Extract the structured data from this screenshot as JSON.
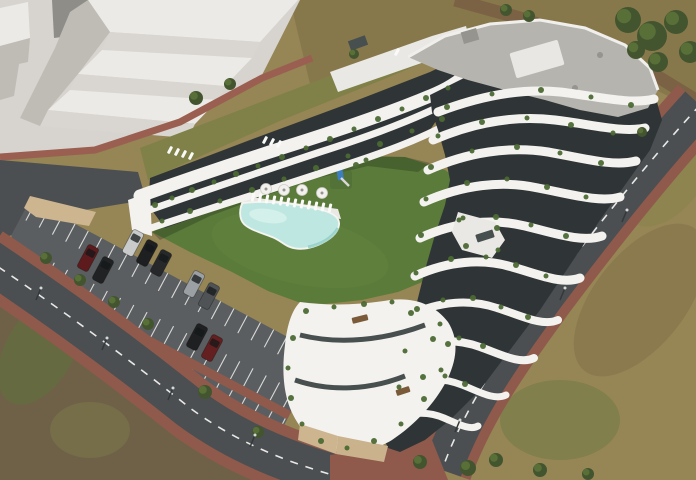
{
  "scene": {
    "type": "aerial 3D architectural render",
    "subject": "Modern terraced apartment complex with curved white balconies, gravel roof, communal lawn courtyard with free-form swimming pool, sun loungers, round tables, children's playground, perimeter roads and a surface parking lot with cars, surrounded by scrubland and white massing blocks of neighbouring buildings",
    "visible_text": ""
  },
  "colors": {
    "scrub": "#968555",
    "scrub_dark": "#7c6d46",
    "dirt": "#6f6148",
    "grass_olive": "#7f8148",
    "plaza": "#d7d4cf",
    "block_light": "#eceae6",
    "block_mid": "#d9d6d1",
    "block_shadow": "#bfbcb6",
    "block_dark": "#8f8d88",
    "lawn": "#5a7b3a",
    "lawn_light": "#6b8a46",
    "tree_dark": "#43552f",
    "tree_light": "#5c7539",
    "path_dirt": "#7b6244",
    "brick": "#9a5f50",
    "brick_dark": "#8f5a4b",
    "road": "#4b4f52",
    "road_line": "#e8e8e6",
    "lot_asphalt": "#5b5e60",
    "stall_line": "#d9d9d7",
    "tan_wall": "#cdb58f",
    "tan_wall2": "#c9b28c",
    "building_white": "#f3f2ef",
    "building_dim": "#e9e8e4",
    "glass": "#2f3536",
    "glass_light": "#47504f",
    "roof_gravel": "#b6b4af",
    "roof_dot": "#96948f",
    "roof_box": "#e8e7e3",
    "pool": "#bfe7e1",
    "pool_light": "#d9f2ee",
    "pool_deep": "#8ecec6",
    "plant": "#4c6a34",
    "bench": "#7a5a38",
    "playground_blue": "#3d7ec0",
    "shadow": "rgba(25,35,20,0.28)",
    "car_outline": "rgba(15,15,15,0.4)"
  },
  "site": {
    "building": {
      "material": "white curved balcony bands with dark glazing",
      "roof": "grey gravel flat roof with rooftop boxes",
      "floors_visible": 7,
      "wings": [
        "north terraced wing",
        "tall east wing",
        "low south wing with roof terraces"
      ]
    },
    "courtyard": {
      "pool_shape": "free-form",
      "loungers_count": 12,
      "roof_loungers_count": 8,
      "tables_count": 4,
      "playground": "blue tower with slide on lawn"
    },
    "parking": {
      "stall_rows": 3,
      "median": "brick strip with trees and lamps",
      "cars_count": 9,
      "stall_angle_deg": 28,
      "rows": [
        {
          "x0": 6,
          "x1": 328,
          "y0": 0,
          "y1": 20,
          "step": 15
        },
        {
          "x0": 36,
          "x1": 328,
          "y0": 44,
          "y1": 64,
          "step": 15
        },
        {
          "x0": 118,
          "x1": 328,
          "y0": 73,
          "y1": 93,
          "step": 15
        }
      ]
    },
    "roads": [
      "two-lane road with dashed centreline along south-west",
      "two-lane road with dashed centreline along south-east",
      "red brick sidewalks"
    ],
    "surroundings": [
      "white massing blocks on concrete plaza (north-west)",
      "scrubland and trees (north-east, east, south)",
      "dirt patch (south-west)"
    ]
  },
  "cars": [
    {
      "name": "silver-car",
      "hex": "#c9cbcb",
      "x": 133,
      "y": 243
    },
    {
      "name": "black-car",
      "hex": "#1d1f21",
      "x": 147,
      "y": 253
    },
    {
      "name": "black-car",
      "hex": "#26282a",
      "x": 161,
      "y": 263
    },
    {
      "name": "dark-red-car",
      "hex": "#5e1b1d",
      "x": 88,
      "y": 258
    },
    {
      "name": "black-car",
      "hex": "#202224",
      "x": 103,
      "y": 270
    },
    {
      "name": "silver-suv",
      "hex": "#9aa0a3",
      "x": 194,
      "y": 284
    },
    {
      "name": "grey-suv",
      "hex": "#4f5356",
      "x": 209,
      "y": 296
    },
    {
      "name": "black-car",
      "hex": "#1e2022",
      "x": 197,
      "y": 337
    },
    {
      "name": "dark-red-car",
      "hex": "#641f20",
      "x": 212,
      "y": 348
    }
  ],
  "trees": [
    [
      46,
      258,
      6
    ],
    [
      80,
      280,
      6
    ],
    [
      114,
      302,
      6
    ],
    [
      148,
      324,
      6
    ],
    [
      205,
      392,
      7
    ],
    [
      258,
      432,
      6
    ],
    [
      628,
      20,
      13
    ],
    [
      652,
      36,
      15
    ],
    [
      676,
      22,
      12
    ],
    [
      690,
      52,
      11
    ],
    [
      658,
      62,
      10
    ],
    [
      636,
      50,
      9
    ],
    [
      506,
      10,
      6
    ],
    [
      529,
      16,
      6
    ],
    [
      196,
      98,
      7
    ],
    [
      230,
      84,
      6
    ],
    [
      354,
      54,
      5
    ],
    [
      642,
      132,
      5
    ],
    [
      420,
      462,
      7
    ],
    [
      468,
      468,
      8
    ],
    [
      496,
      460,
      7
    ],
    [
      540,
      470,
      7
    ],
    [
      588,
      474,
      6
    ]
  ],
  "lamps": [
    [
      36,
      300
    ],
    [
      102,
      350
    ],
    [
      168,
      400
    ],
    [
      250,
      447
    ],
    [
      560,
      300
    ],
    [
      622,
      222
    ],
    [
      455,
      432
    ]
  ],
  "terrace_plants": [
    [
      155,
      205,
      3
    ],
    [
      172,
      198,
      2.5
    ],
    [
      192,
      190,
      3
    ],
    [
      214,
      182,
      2.5
    ],
    [
      236,
      174,
      3
    ],
    [
      258,
      166,
      2.5
    ],
    [
      282,
      157,
      3
    ],
    [
      306,
      148,
      2.5
    ],
    [
      330,
      139,
      3
    ],
    [
      354,
      129,
      2.5
    ],
    [
      378,
      119,
      3
    ],
    [
      402,
      109,
      2.5
    ],
    [
      426,
      98,
      3
    ],
    [
      448,
      88,
      2.5
    ],
    [
      162,
      221,
      2.5
    ],
    [
      190,
      211,
      3
    ],
    [
      220,
      201,
      2.5
    ],
    [
      252,
      190,
      3
    ],
    [
      284,
      179,
      2.5
    ],
    [
      316,
      168,
      3
    ],
    [
      348,
      156,
      2.5
    ],
    [
      380,
      144,
      3
    ],
    [
      412,
      131,
      2.5
    ],
    [
      442,
      119,
      3
    ],
    [
      447,
      107,
      3
    ],
    [
      492,
      94,
      2.5
    ],
    [
      541,
      90,
      3
    ],
    [
      591,
      97,
      2.5
    ],
    [
      631,
      105,
      3
    ],
    [
      438,
      136,
      2.5
    ],
    [
      482,
      122,
      3
    ],
    [
      527,
      118,
      2.5
    ],
    [
      571,
      125,
      3
    ],
    [
      613,
      133,
      2.5
    ],
    [
      431,
      167,
      3
    ],
    [
      472,
      151,
      2.5
    ],
    [
      517,
      147,
      3
    ],
    [
      560,
      153,
      2.5
    ],
    [
      601,
      163,
      3
    ],
    [
      426,
      199,
      2.5
    ],
    [
      467,
      183,
      3
    ],
    [
      507,
      179,
      2.5
    ],
    [
      547,
      187,
      3
    ],
    [
      586,
      197,
      2.5
    ],
    [
      421,
      235,
      3
    ],
    [
      459,
      220,
      2.5
    ],
    [
      496,
      217,
      3
    ],
    [
      531,
      225,
      2.5
    ],
    [
      566,
      236,
      3
    ],
    [
      416,
      273,
      2.5
    ],
    [
      451,
      259,
      3
    ],
    [
      486,
      257,
      2.5
    ],
    [
      516,
      265,
      3
    ],
    [
      546,
      276,
      2.5
    ],
    [
      411,
      313,
      3
    ],
    [
      443,
      300,
      2.5
    ],
    [
      473,
      298,
      3
    ],
    [
      501,
      307,
      2.5
    ],
    [
      528,
      317,
      3
    ],
    [
      405,
      351,
      2.5
    ],
    [
      433,
      339,
      3
    ],
    [
      459,
      338,
      2.5
    ],
    [
      483,
      346,
      3
    ],
    [
      399,
      387,
      2.5
    ],
    [
      423,
      377,
      3
    ],
    [
      445,
      376,
      2.5
    ],
    [
      465,
      384,
      3
    ],
    [
      306,
      311,
      3
    ],
    [
      334,
      307,
      2.5
    ],
    [
      364,
      304,
      3
    ],
    [
      392,
      302,
      2.5
    ],
    [
      417,
      309,
      3
    ],
    [
      440,
      324,
      2.5
    ],
    [
      448,
      344,
      3
    ],
    [
      441,
      370,
      2.5
    ],
    [
      424,
      399,
      3
    ],
    [
      401,
      424,
      2.5
    ],
    [
      374,
      441,
      3
    ],
    [
      347,
      448,
      2.5
    ],
    [
      321,
      441,
      3
    ],
    [
      302,
      424,
      2.5
    ],
    [
      291,
      398,
      3
    ],
    [
      288,
      368,
      2.5
    ],
    [
      293,
      338,
      3
    ],
    [
      463,
      218,
      2.5
    ],
    [
      497,
      228,
      3
    ],
    [
      498,
      250,
      2.5
    ],
    [
      466,
      246,
      3
    ],
    [
      356,
      165,
      3
    ],
    [
      366,
      160,
      2.5
    ]
  ],
  "loungers": [
    [
      253,
      197
    ],
    [
      260,
      198
    ],
    [
      267,
      199
    ],
    [
      274,
      200
    ],
    [
      281,
      201
    ],
    [
      288,
      202
    ],
    [
      295,
      203
    ],
    [
      302,
      204
    ],
    [
      309,
      205
    ],
    [
      316,
      206
    ],
    [
      323,
      207
    ],
    [
      330,
      208
    ]
  ],
  "roof_loungers": [
    [
      170,
      150
    ],
    [
      177,
      152
    ],
    [
      184,
      154
    ],
    [
      191,
      156
    ],
    [
      265,
      140
    ],
    [
      272,
      142
    ],
    [
      279,
      144
    ],
    [
      397,
      52
    ]
  ],
  "tables": [
    [
      266,
      189
    ],
    [
      284,
      190
    ],
    [
      302,
      190
    ],
    [
      322,
      193
    ]
  ]
}
